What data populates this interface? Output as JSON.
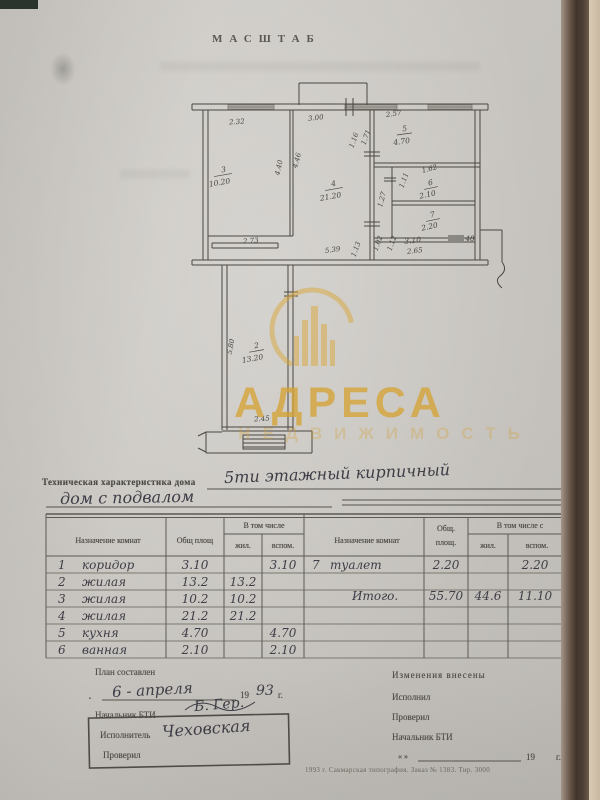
{
  "header": {
    "title": "МАСШТАБ"
  },
  "watermark": {
    "brand": "АДРЕСА",
    "subtext": "НЕДВИЖИМОСТЬ",
    "color": "#d8a63a"
  },
  "plan": {
    "labels": [
      {
        "t": "2.32"
      },
      {
        "t": "3.00"
      },
      {
        "t": "2.57"
      },
      {
        "t": "5"
      },
      {
        "t": "4.70"
      },
      {
        "t": "3"
      },
      {
        "t": "10.20"
      },
      {
        "t": "4.40"
      },
      {
        "t": "4.46"
      },
      {
        "t": "4"
      },
      {
        "t": "21.20"
      },
      {
        "t": "1.16"
      },
      {
        "t": "1.71"
      },
      {
        "t": "1.62"
      },
      {
        "t": "1.11"
      },
      {
        "t": "6"
      },
      {
        "t": "2.10"
      },
      {
        "t": "1.27"
      },
      {
        "t": "7"
      },
      {
        "t": "2.20"
      },
      {
        "t": "1.02"
      },
      {
        "t": "1.12"
      },
      {
        "t": "3.10"
      },
      {
        "t": "2.65"
      },
      {
        "t": "48"
      },
      {
        "t": "5.39"
      },
      {
        "t": "1.13"
      },
      {
        "t": "2.73"
      },
      {
        "t": "5.80"
      },
      {
        "t": "2"
      },
      {
        "t": "13.20"
      },
      {
        "t": "2.45"
      }
    ]
  },
  "tech": {
    "label": "Техническая характеристика дома",
    "hand1": "5ти этажный кирпичный",
    "hand2": "дом с подвалом"
  },
  "table": {
    "header": {
      "col_room": "Назначение комнат",
      "col_total": "Общ площ",
      "col_incl": "В том числе",
      "col_liv": "жил.",
      "col_aux": "вспом.",
      "col_room2": "Назначение комнат",
      "col_total2a": "Общ.",
      "col_total2b": "площ.",
      "col_incl2": "В том числе с",
      "col_liv2": "жил.",
      "col_aux2": "вспом."
    },
    "left_rows": [
      {
        "n": "1",
        "name": "коридор",
        "total": "3.10",
        "liv": "",
        "aux": "3.10"
      },
      {
        "n": "2",
        "name": "жилая",
        "total": "13.2",
        "liv": "13.2",
        "aux": ""
      },
      {
        "n": "3",
        "name": "жилая",
        "total": "10.2",
        "liv": "10.2",
        "aux": ""
      },
      {
        "n": "4",
        "name": "жилая",
        "total": "21.2",
        "liv": "21.2",
        "aux": ""
      },
      {
        "n": "5",
        "name": "кухня",
        "total": "4.70",
        "liv": "",
        "aux": "4.70"
      },
      {
        "n": "6",
        "name": "ванная",
        "total": "2.10",
        "liv": "",
        "aux": "2.10"
      }
    ],
    "right_rows": [
      {
        "n": "7",
        "name": "туалет",
        "total": "2.20",
        "liv": "",
        "aux": "2.20"
      },
      {
        "n": "",
        "name": "Итого.",
        "total": "55.70",
        "liv": "44.6",
        "aux": "11.10"
      }
    ]
  },
  "footer": {
    "left": {
      "plan_label": "План составлен",
      "dot": ".",
      "date_hand": "6 - апреля",
      "year": "19",
      "year_hand": "93",
      "g": "г.",
      "chief_label": "Начальник БТИ",
      "chief_sign": "Б. Гер.",
      "executor_label": "Исполнитель",
      "executor_sign": "Чеховская",
      "checked_label": "Проверил"
    },
    "right": {
      "changes_label": "Изменения внесены",
      "done_label": "Исполнил",
      "checked_label": "Проверил",
      "chief_label": "Начальник БТИ",
      "quote": "«    »",
      "year": "19",
      "g": "г.",
      "printline": "1993 г. Сакмарская типография. Заказ № 1383. Тир. 3000"
    }
  }
}
